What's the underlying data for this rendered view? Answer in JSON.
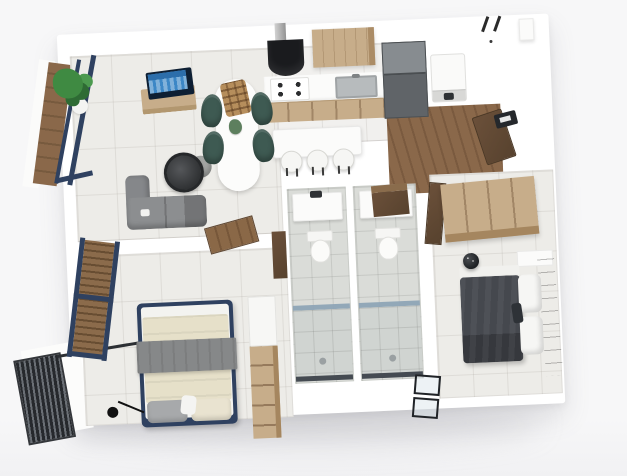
{
  "scene": {
    "kind": "3d-floorplan-top-view-render",
    "colors": {
      "bg": "#f7f7f8",
      "wall": "#ffffff",
      "floor": "#edece8",
      "floor_kitchen": "#f1f0ee",
      "bath_tile": "#dadcd8",
      "shower_tile": "#d0d4d1",
      "wood_light": "#c7ad8a",
      "wood_mid": "#8a684a",
      "wood_dark": "#6b503a",
      "navy": "#2f4160",
      "sofa": "#8c8e90",
      "chair_green": "#3e5a52",
      "table_white": "#fcfcfb",
      "duvet_dark": "#45484e",
      "duvet_cream": "#e6e0c9",
      "blanket_gray": "#868889",
      "tv_blue": "#3c87c6",
      "glass": "#8ea4b6",
      "steel": "#b7bbbd",
      "black": "#1a1b1e",
      "fridge_gray": "#606468",
      "railing_dark": "#26292d",
      "plant_green": "#3f8a42",
      "pillow_white": "#f6f6f4"
    },
    "rooms": [
      {
        "id": "living-dining",
        "name": "Living / Dining Room"
      },
      {
        "id": "kitchen",
        "name": "Kitchen"
      },
      {
        "id": "entry",
        "name": "Entry Hall"
      },
      {
        "id": "hallway",
        "name": "Hallway"
      },
      {
        "id": "bathroom-1",
        "name": "Bathroom 1"
      },
      {
        "id": "bathroom-2",
        "name": "Bathroom 2"
      },
      {
        "id": "bedroom-1",
        "name": "Bedroom 1"
      },
      {
        "id": "bedroom-2",
        "name": "Bedroom 2"
      },
      {
        "id": "balcony-top",
        "name": "Balcony (upper left)"
      },
      {
        "id": "balcony-bottom",
        "name": "Balcony (lower left)"
      }
    ],
    "furniture": {
      "living_dining": [
        "corner-sofa",
        "round-coffee-table",
        "pouf",
        "tv-sideboard",
        "flat-tv",
        "dining-table",
        "dining-chair x4",
        "rattan-pendant-lamp",
        "table-plant",
        "potted-plant"
      ],
      "kitchen": [
        "range-hood",
        "cooktop-4-burners",
        "upper-cabinet",
        "counter-with-sink",
        "lower-cabinets",
        "tall-fridge-unit",
        "island-counter",
        "bar-stool x3"
      ],
      "entry": [
        "washing-machine",
        "wall-hooks x2",
        "floating-shelf",
        "intercom-panel",
        "entry-door-open"
      ],
      "bathrooms": [
        "vanity-sink x2",
        "toilet x2",
        "walk-in-shower x2",
        "glass-partition x2",
        "overdoor-cabinet",
        "glass-shower-door"
      ],
      "bedroom_1": [
        "double-bed-navy-frame",
        "cream-duvet",
        "gray-blanket",
        "pillows",
        "floor-lamp",
        "wardrobe-dresser",
        "window-with-shutter",
        "door-open"
      ],
      "bedroom_2": [
        "double-bed",
        "dark-duvet",
        "white-pillows",
        "wood-headboard",
        "wardrobe",
        "black-vase",
        "door-open"
      ]
    },
    "counts": {
      "dining_chairs": 4,
      "bar_stools": 3,
      "bathrooms": 2,
      "bedrooms": 2,
      "toilets": 2,
      "showers": 2
    }
  }
}
